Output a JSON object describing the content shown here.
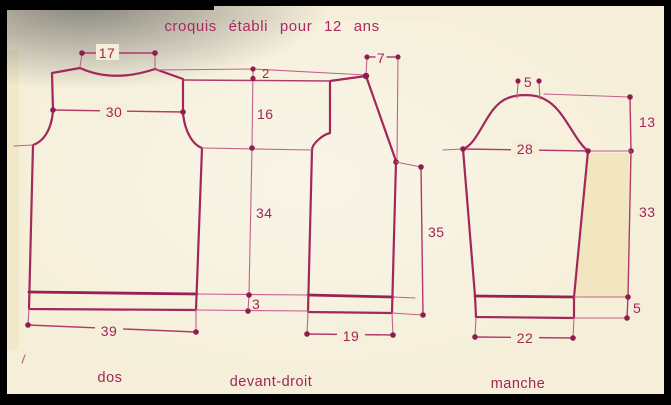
{
  "title": "croquis établi pour 12 ans",
  "colors": {
    "ink": "#a2275a",
    "ink_light": "#c4608a",
    "text": "#a22558",
    "background": "#f5efd9",
    "paper_shade_yellow": "#f1e4ba",
    "border": "#000000"
  },
  "pieces": {
    "dos": {
      "label": "dos",
      "dimensions": {
        "neck_width": "17",
        "chest_width": "30",
        "hem_width": "39"
      }
    },
    "devant_droit": {
      "label": "devant-droit",
      "dimensions": {
        "shoulder_drop": "2",
        "shoulder_width": "7",
        "armhole_depth": "16",
        "side_length": "34",
        "ribbing_height": "3",
        "hem_width": "19",
        "front_length": "35"
      }
    },
    "manche": {
      "label": "manche",
      "dimensions": {
        "cap_top_width": "5",
        "cap_height": "13",
        "upper_width": "28",
        "underarm_length": "33",
        "cuff_height": "5",
        "cuff_width": "22"
      }
    }
  }
}
